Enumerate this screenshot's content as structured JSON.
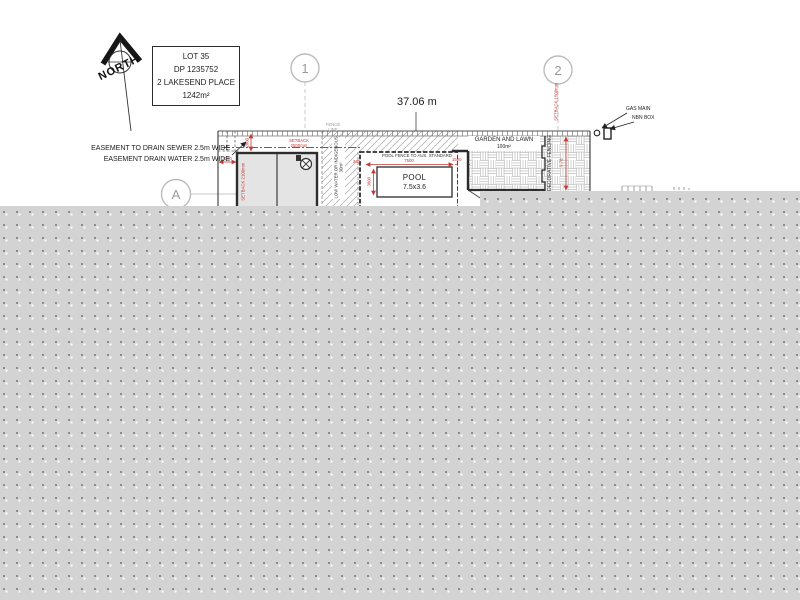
{
  "north": {
    "label": "NORTH"
  },
  "lot_box": {
    "lines": [
      "LOT 35",
      "DP 1235752",
      "2 LAKESEND PLACE",
      "1242m²"
    ]
  },
  "grid": {
    "marker1": "1",
    "marker2": "2",
    "markerA": "A"
  },
  "dimensions": {
    "frontage": "37.06 m",
    "setback_top_l1": "SETBACK",
    "setback_top_l2": "2500mm",
    "setback_left_l1": "SETBACK",
    "setback_left_l2": "2100mm",
    "setback_right_l1": "SETBACK",
    "setback_right_l2": "1500mm",
    "dim_2100": "2100",
    "dim_2800": "2800",
    "dim_7500": "7500",
    "dim_1500": "1500",
    "dim_3600": "3600",
    "dim_200": "200",
    "dim_side": "9.78"
  },
  "easement": {
    "line1": "EASEMENT TO DRAIN SEWER 2.5m WIDE",
    "line2": "EASEMENT DRAIN WATER 2.5m WIDE"
  },
  "utilities": {
    "gas": "GAS MAIN",
    "nbn": "NBN BOX"
  },
  "garden": {
    "label": "GARDEN AND LAWN",
    "area": "100m²"
  },
  "pool": {
    "label": "POOL",
    "size": "7.5x3.6",
    "fence_note": "POOL FENCE TO AUS. STANDARD"
  },
  "landscaping": {
    "strip_label": "LOW WATER OR INDIGENOUS",
    "strip_area": "30m²",
    "decorative_fencing": "DECORATIVE FENCING"
  },
  "fence_note": {
    "l1": "FENCE",
    "l2": "LINE"
  },
  "icons": {
    "north_arrow": "north-arrow-icon",
    "gas_symbol": "gas-main-symbol",
    "nbn_symbol": "nbn-box-symbol",
    "fixture_symbol": "building-fixture-symbol"
  },
  "colors": {
    "dimension_red": "#c23a36",
    "line_dark": "#3a3a3a",
    "grid_gray": "#b5b5b5",
    "overlay_gray": "#d3d3d3",
    "building_fill": "#e4e4e4"
  }
}
